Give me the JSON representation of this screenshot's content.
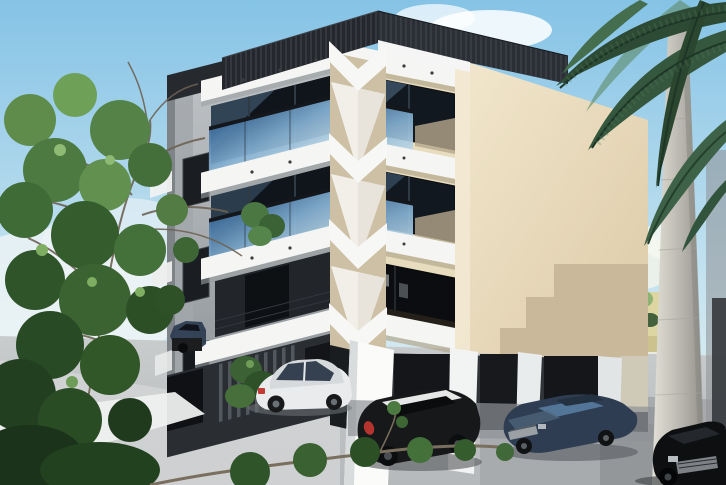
{
  "image": {
    "width": 726,
    "height": 485,
    "alt": "3D architectural rendering of a modern four-storey apartment building with white zigzag balcony slabs, blue glass railings, a blank beige side wall, ground-floor pilotis parking with several cars, a leafy tree on the left and a palm tree on the right under a clear blue sky"
  },
  "scene": {
    "type": "architectural-render",
    "objects": [
      {
        "name": "sky",
        "label": "Clear blue sky with soft cloud"
      },
      {
        "name": "apartment-building",
        "label": "Four-storey modern apartment building"
      },
      {
        "name": "rooftop-parapet",
        "label": "Black slatted rooftop parapet"
      },
      {
        "name": "balcony-railings",
        "label": "Blue tinted glass balcony railings"
      },
      {
        "name": "zigzag-slabs",
        "label": "White chevron balcony slabs with downlights"
      },
      {
        "name": "side-wall",
        "label": "Blank beige side wall with stepped shadow"
      },
      {
        "name": "ground-floor-parking",
        "label": "Pilotis parking beneath the building"
      },
      {
        "name": "white-sedan",
        "label": "White sedan parked under building"
      },
      {
        "name": "black-hatchback",
        "label": "Black hatchback with light roof"
      },
      {
        "name": "blue-sedan",
        "label": "Dark blue sedan"
      },
      {
        "name": "black-sedan",
        "label": "Black sedan at right edge"
      },
      {
        "name": "garage-car",
        "label": "Blue car inside left garage bay"
      },
      {
        "name": "deciduous-tree",
        "label": "Leafy green tree on the left"
      },
      {
        "name": "palm-tree",
        "label": "Palm trunk and fronds on the right"
      },
      {
        "name": "driveway",
        "label": "Light grey concrete driveway"
      },
      {
        "name": "neighbor-wall",
        "label": "Pale yellow boundary wall with shrubs"
      }
    ]
  },
  "palette": {
    "sky_top": "#85c3e6",
    "sky_mid": "#c2e1ef",
    "sky_low": "#edf5f2",
    "parapet": "#24272c",
    "slab": "#f5f6f4",
    "wall_gray": "#b2b6b9",
    "wall_tan": "#e8dcbf",
    "wall_side": "#ecdfc4",
    "taupe": "#c2b496",
    "glass_a": "#3f6f9e",
    "glass_b": "#86b2d4",
    "glass_c": "#bad7e8",
    "window_dark": "#12181f",
    "ground": "#c9cccd",
    "ground_shade": "#9fa3a7",
    "curb": "#eef0ef",
    "trunk_a": "#e3e1d7",
    "trunk_b": "#918f89",
    "palm_dark": "#2c4a34",
    "palm_mid": "#446e4e",
    "leaf_dark": "#2f5429",
    "leaf_mid": "#4c7a40",
    "leaf_light": "#8fba74",
    "car_white": "#e9ebec",
    "car_black": "#17181a",
    "car_blue": "#2e3d52",
    "car_dark": "#0e0f11",
    "neighbor_wall": "#ded6a2"
  }
}
